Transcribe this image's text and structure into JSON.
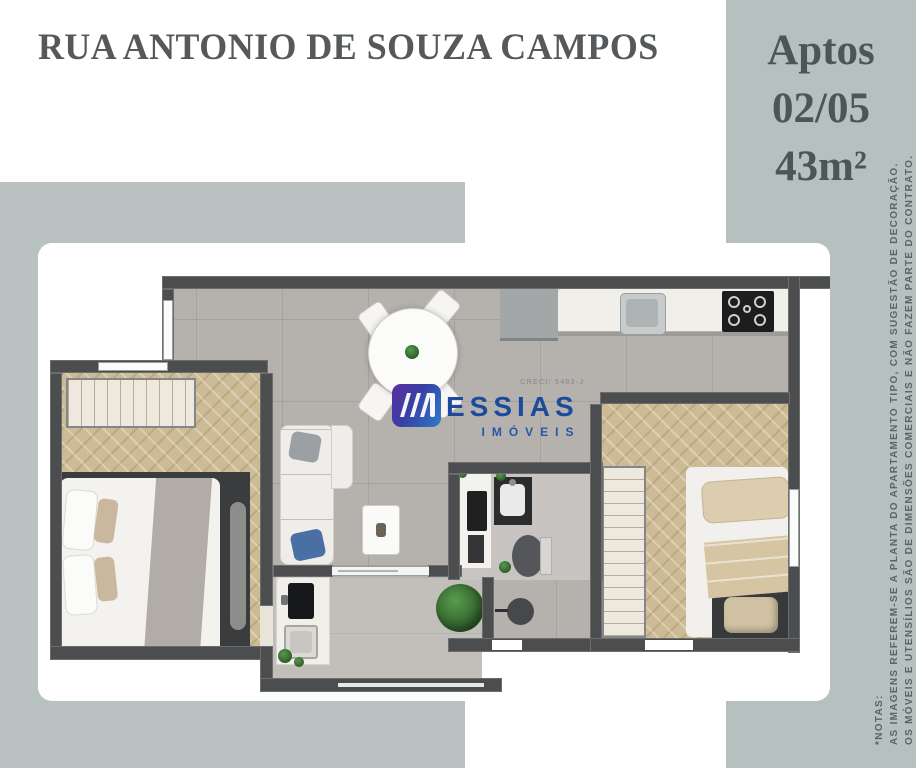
{
  "title": "RUA ANTONIO DE SOUZA CAMPOS",
  "side_panel": {
    "line1": "Aptos",
    "line2": "02/05",
    "line3": "43m²"
  },
  "notes": {
    "header": "*NOTAS:",
    "lines": [
      "AS IMAGENS REFEREM-SE A PLANTA DO APARTAMENTO TIPO, COM SUGESTÃO DE DECORAÇÃO.",
      "OS MÓVEIS E UTENSÍLIOS SÃO DE DIMENSÕES COMERCIAIS E NÃO FAZEM PARTE DO CONTRATO."
    ]
  },
  "watermark": {
    "brand": "ESSIAS",
    "subbrand": "IMÓVEIS",
    "creci": "CRECI: 5493-J"
  },
  "colors": {
    "sage_left": "#b9c2c1",
    "sage_right": "#b6c0bf",
    "title_gray": "#56595b",
    "wall_gray": "#4b4d4f",
    "herringbone_tan": "#ccbb95",
    "tile_gray": "#b5b1ad",
    "brand_blue": "#1c4a9c",
    "logo_gradient_start": "#5b2f9e",
    "logo_gradient_end": "#2f7cc9",
    "accent_pillow_blue": "#4a6fa5"
  }
}
